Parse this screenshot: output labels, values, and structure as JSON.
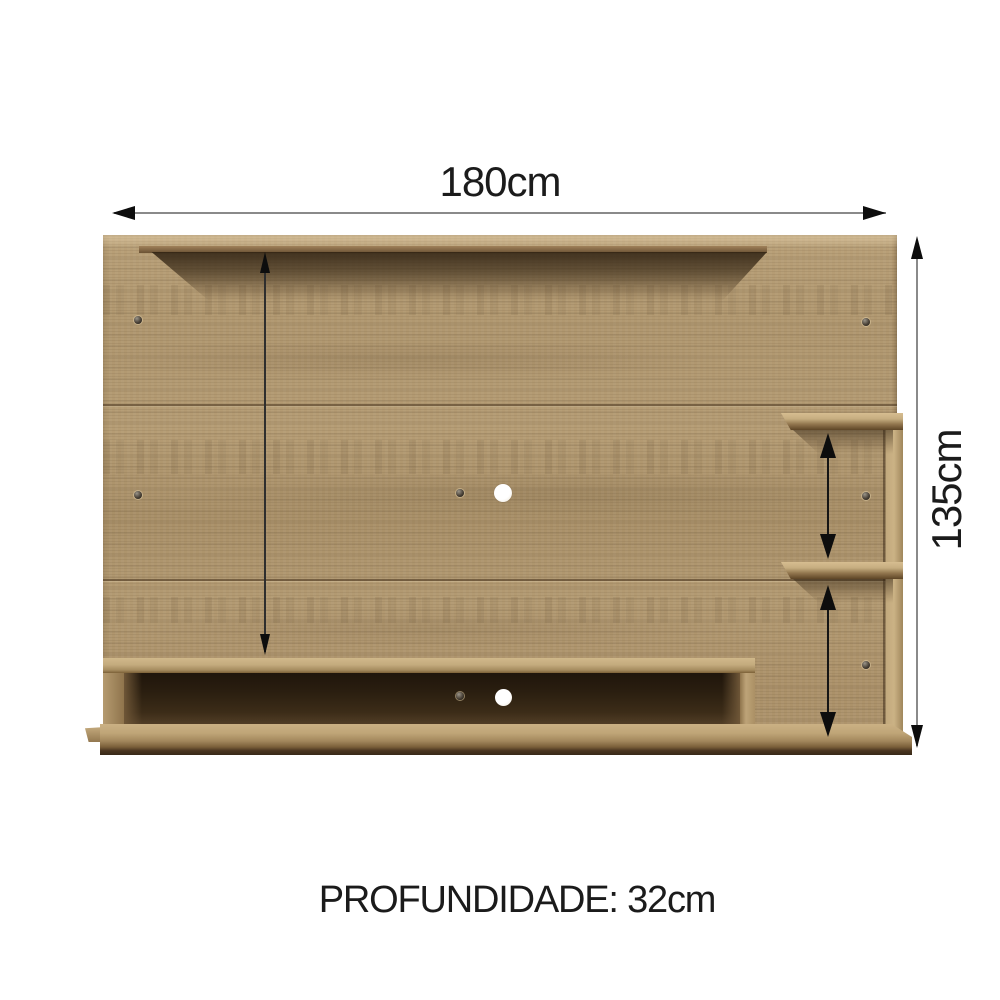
{
  "diagram": {
    "type": "furniture-dimension-diagram",
    "product": "wall-mounted TV panel"
  },
  "dimensions": {
    "width": "180cm",
    "height": "135cm",
    "inner_height": "105cm",
    "upper_shelf_gap": "36cm",
    "lower_shelf_gap": "40cm",
    "depth": "PROFUNDIDADE: 32cm"
  },
  "colors": {
    "wood_base": "#af9670",
    "wood_light": "#cdb488",
    "wood_dark": "#6b5335",
    "niche_interior": "#2b1f10",
    "dimension_line_gray": "#8a8a8a",
    "dimension_line_black": "#151515",
    "text": "#1b1b1b",
    "background": "#ffffff"
  }
}
